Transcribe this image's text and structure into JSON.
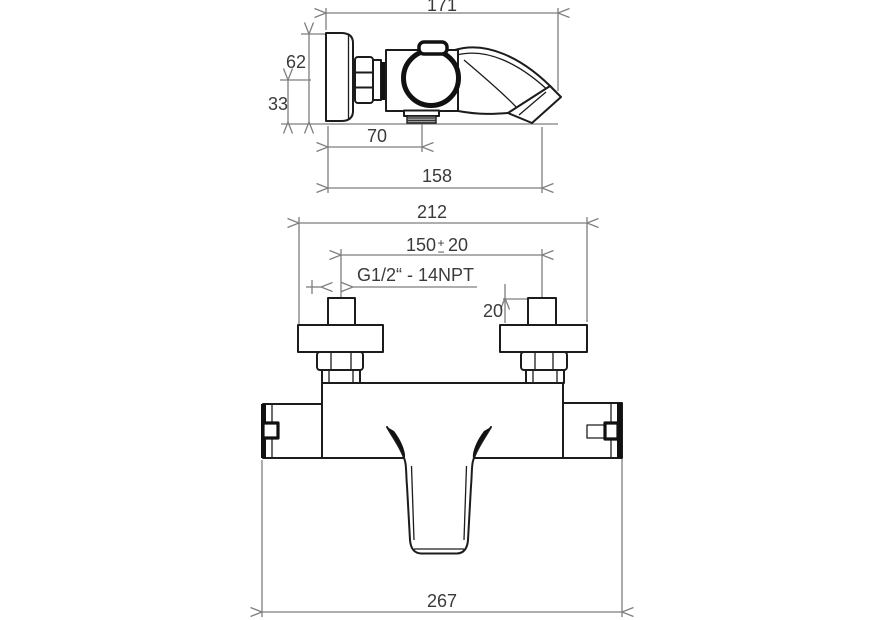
{
  "colors": {
    "background": "#ffffff",
    "outline": "#1c1c1c",
    "dimension_lines": "#7e7e7e",
    "label_text": "#3a3a3a",
    "thread_fill": "#9a9a9a"
  },
  "side_view": {
    "dim_overall_length": "171",
    "dim_height": "62",
    "dim_outlet_axis_height": "33",
    "dim_outlet_offset": "70",
    "dim_spout_reach": "158"
  },
  "front_view": {
    "dim_overall_width": "212",
    "dim_connection_span": "150",
    "dim_span_tolerance_plus": "+",
    "dim_span_tolerance_minus": "−",
    "dim_span_tolerance_value": "20",
    "thread_spec": "G1/2“ - 14NPT",
    "dim_thread_length": "20",
    "dim_overall_width_total": "267"
  }
}
